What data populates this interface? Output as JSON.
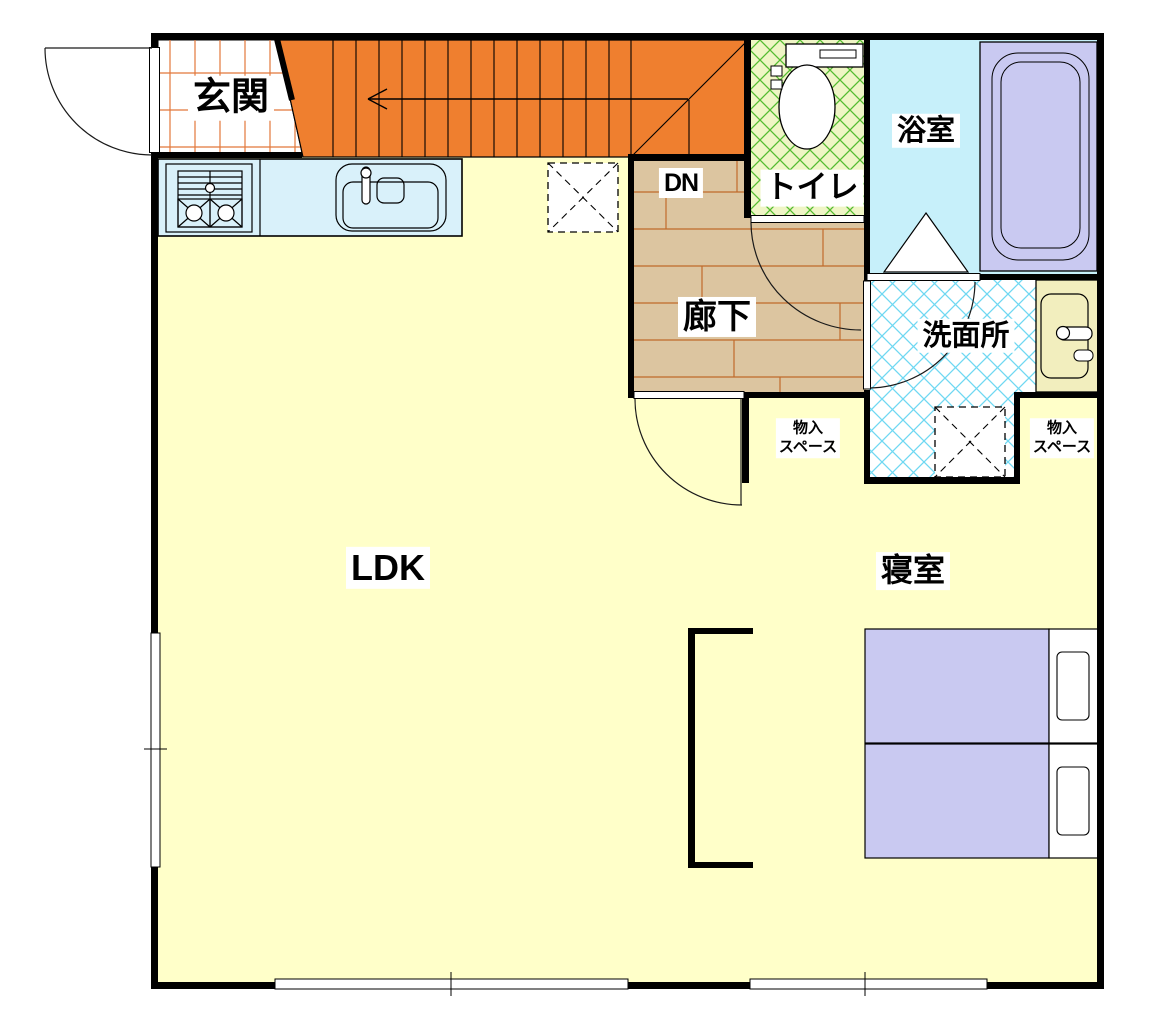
{
  "floor_plan": {
    "rooms": {
      "genkan": {
        "label": "玄関"
      },
      "staircase": {
        "down_label": "DN"
      },
      "toilet": {
        "label": "トイレ"
      },
      "bathroom": {
        "label": "浴室"
      },
      "hallway": {
        "label": "廊下"
      },
      "washroom": {
        "label": "洗面所"
      },
      "storage_left": {
        "line1": "物入",
        "line2": "スペース"
      },
      "storage_right": {
        "line1": "物入",
        "line2": "スペース"
      },
      "ldk": {
        "label": "LDK"
      },
      "bedroom": {
        "label": "寝室"
      }
    },
    "colors": {
      "stairs_orange": "#EF7F2F",
      "floor_yellow": "#FFFFC9",
      "kitchen_blue": "#D9F1FA",
      "toilet_green_bg": "#EFF5C5",
      "toilet_hatch_green": "#54BC30",
      "bath_cyan": "#C7F0FA",
      "tub_purple": "#C9C9F1",
      "hallway_tan": "#DCC5A0",
      "plank_brown": "#C06B2B",
      "wash_hatch_cyan": "#6FD8F2",
      "bed_purple": "#C9C9F1",
      "vanity_cream": "#F2EEBE",
      "genkan_grid_orange": "#E2773B",
      "wall_black": "#000000"
    }
  }
}
